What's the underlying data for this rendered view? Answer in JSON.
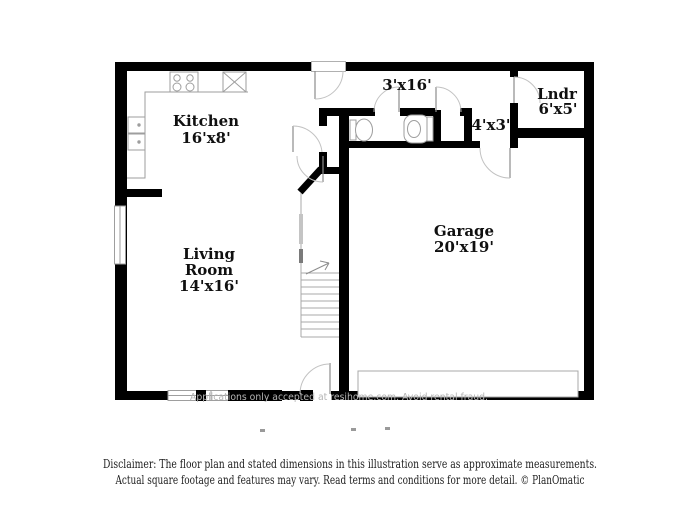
{
  "colors": {
    "wall": "#000000",
    "fixture_line": "#9e9e9e",
    "arc_line": "#c2c2c2",
    "label_text": "#101010",
    "watermark_text": "#b5b5b5",
    "watermark_box": "#000000",
    "disclaimer_text": "#1e1e1e",
    "background": "#ffffff"
  },
  "rooms": {
    "kitchen": {
      "name": "Kitchen",
      "dims": "16'x8'"
    },
    "living_room": {
      "name_line1": "Living",
      "name_line2": "Room",
      "dims": "14'x16'"
    },
    "garage": {
      "name": "Garage",
      "dims": "20'x19'"
    },
    "laundry": {
      "name": "Lndr",
      "dims": "6'x5'"
    },
    "hallway": {
      "dims": "3'x16'"
    },
    "closet": {
      "dims": "4'x3'"
    }
  },
  "watermark": {
    "text": "Applications only accepted at resihome.com. Avoid rental fraud."
  },
  "disclaimer": {
    "line1": "Disclaimer: The floor plan and stated dimensions in this illustration serve as approximate measurements.",
    "line2": "Actual square footage and features may vary. Read terms and conditions for more detail. © PlanOmatic"
  },
  "icons": {
    "stove": "stove-icon",
    "appliance": "appliance-x-icon",
    "kitchen_sink": "double-sink-icon",
    "bath_sink": "sink-icon",
    "toilet": "toilet-icon",
    "stairs": "stairs-icon",
    "garage_door": "garage-door-icon",
    "doors": "door-arc-icon",
    "windows": "window-icon"
  }
}
